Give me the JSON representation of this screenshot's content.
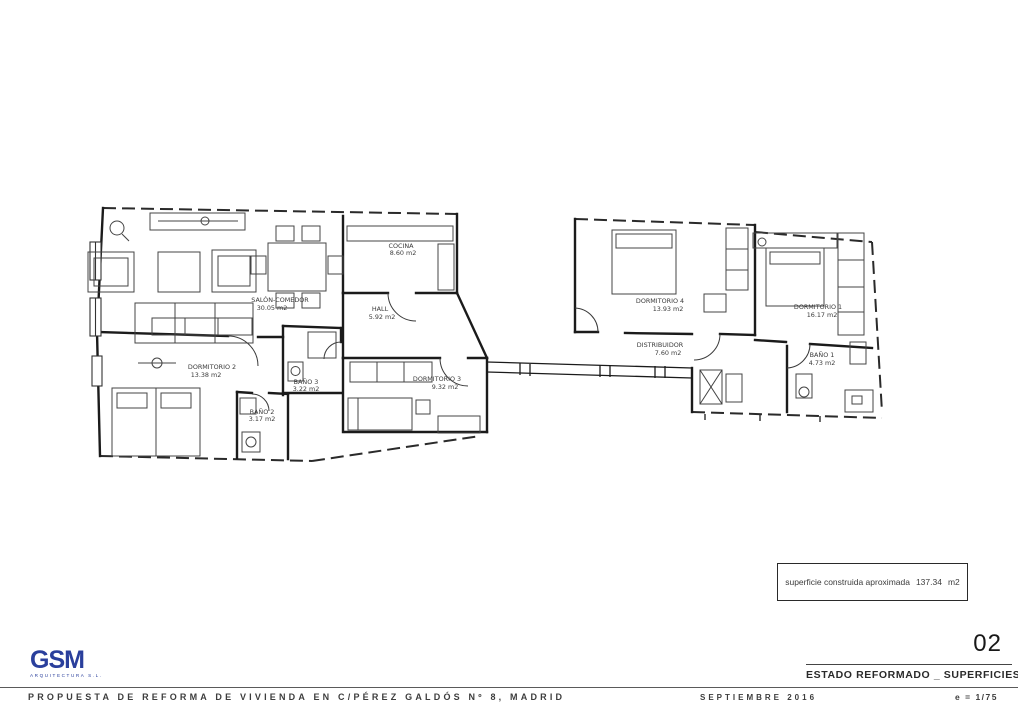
{
  "title_block": {
    "sheet_number": "02",
    "sheet_title": "ESTADO REFORMADO _ SUPERFICIES",
    "project_title": "PROPUESTA DE REFORMA DE VIVIENDA EN C/PÉREZ GALDÓS Nº 8, MADRID",
    "date": "SEPTIEMBRE 2016",
    "scale": "e = 1/75"
  },
  "logo": {
    "text": "GSM",
    "subtext": "ARQUITECTURA S.L.",
    "color": "#2a3f9c"
  },
  "area_note": {
    "label": "superficie construida aproximada",
    "value": "137.34",
    "unit": "m2"
  },
  "plan": {
    "rooms": [
      {
        "name": "SALÓN-COMEDOR",
        "area": "30.05 m2"
      },
      {
        "name": "HALL",
        "area": "5.92 m2"
      },
      {
        "name": "COCINA",
        "area": "8.60 m2"
      },
      {
        "name": "DORMITORIO 4",
        "area": "13.93 m2"
      },
      {
        "name": "DORMITORIO 1",
        "area": "16.17 m2"
      },
      {
        "name": "DISTRIBUIDOR",
        "area": "7.60 m2"
      },
      {
        "name": "BAÑO 1",
        "area": "4.73 m2"
      },
      {
        "name": "DORMITORIO 3",
        "area": "9.32 m2"
      },
      {
        "name": "DORMITORIO 2",
        "area": "13.38 m2"
      },
      {
        "name": "BAÑO 3",
        "area": "3.22 m2"
      },
      {
        "name": "BAÑO 2",
        "area": "3.17 m2"
      }
    ]
  },
  "colors": {
    "ink": "#1b1b1b",
    "logo_blue": "#2a3f9c"
  }
}
